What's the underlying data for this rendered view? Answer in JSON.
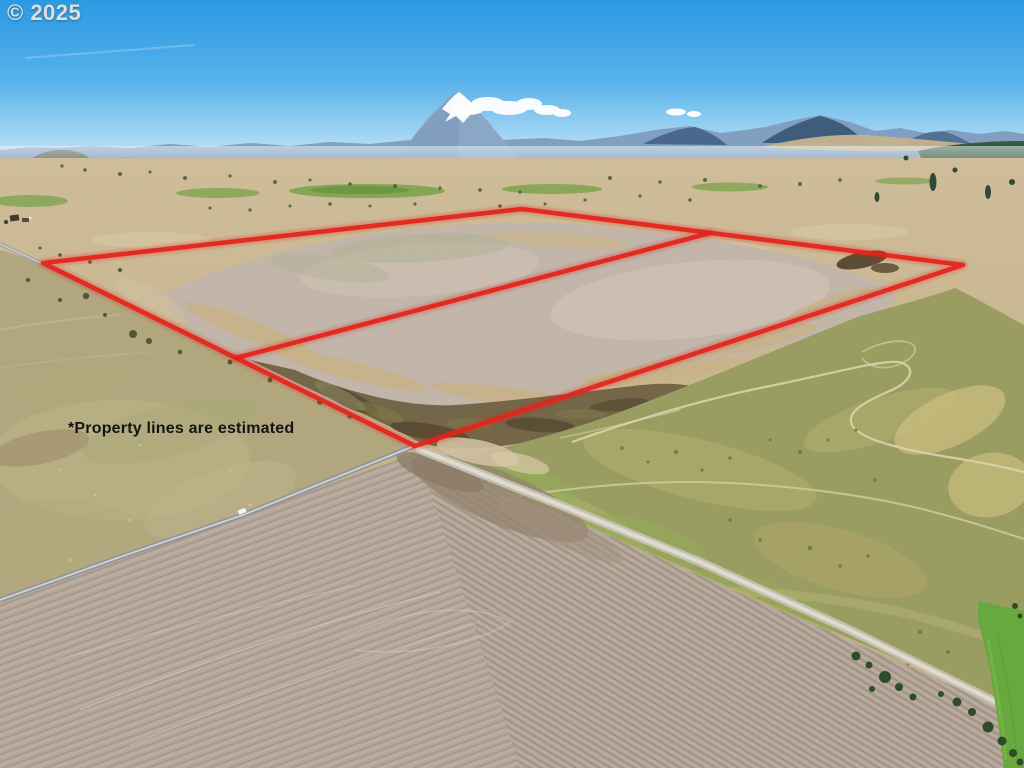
{
  "watermark": {
    "text": "© 2025"
  },
  "annotations": {
    "disclaimer": "*Property lines are estimated"
  },
  "overlay": {
    "color": "#e4231b",
    "stroke_width": 4.6,
    "glow_width": 9.5,
    "boundary_points": "43,263 522,209 963,265 415,446",
    "divider_from": {
      "x": 710,
      "y": 233
    },
    "divider_to": {
      "x": 236,
      "y": 358
    }
  },
  "palette": {
    "sky_top": "#2b99e2",
    "sky_horizon": "#d6edfa",
    "terrain_tan": "#c9b692",
    "lakebed_gray": "#c1b5a9",
    "grass_olive": "#9a9d60",
    "plowed_field": "#b5a89a",
    "road_gray": "#979da1",
    "irrigated_green": "#67a83d",
    "snow_white": "#f7fbfe"
  }
}
